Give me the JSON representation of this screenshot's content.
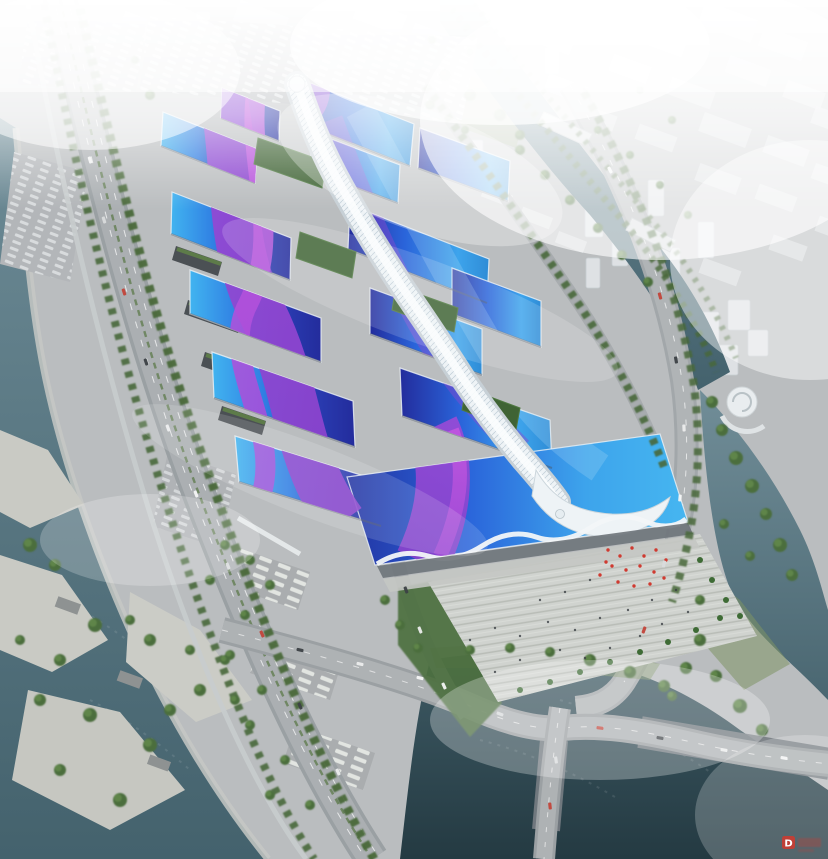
{
  "image": {
    "type": "aerial-architectural-rendering",
    "subject": "Aerial bird's-eye rendering of a large exhibition and convention center with wavy blue roofs crossed by purple ribbon graphics and a white central concourse spine, flanked by rivers, highways, parking lots, a forecourt plaza with red flags, and a hazy white city skyline to the north",
    "width": 828,
    "height": 859
  },
  "watermark": {
    "letter": "D",
    "color": "#d2392e"
  },
  "colors": {
    "ground": "#babdbf",
    "hall_cyan": "#41b4f0",
    "hall_blue": "#2a64da",
    "hall_deep": "#232c9c",
    "hall_east_bright": "#3da4ec",
    "ribbon_purple": "#8a42cc",
    "ribbon_magenta": "#c857e0",
    "spine_white": "#eef3f6",
    "water_light": "#6d8b96",
    "water_deep": "#44626d",
    "water_dark": "#243a42",
    "road": "#9aa0a3",
    "plaza": "#d0d3cf",
    "tree": "#4c6e3e",
    "flag_red": "#cf3a30",
    "facade": "#6e747a",
    "green_roof": "#3f6334"
  }
}
